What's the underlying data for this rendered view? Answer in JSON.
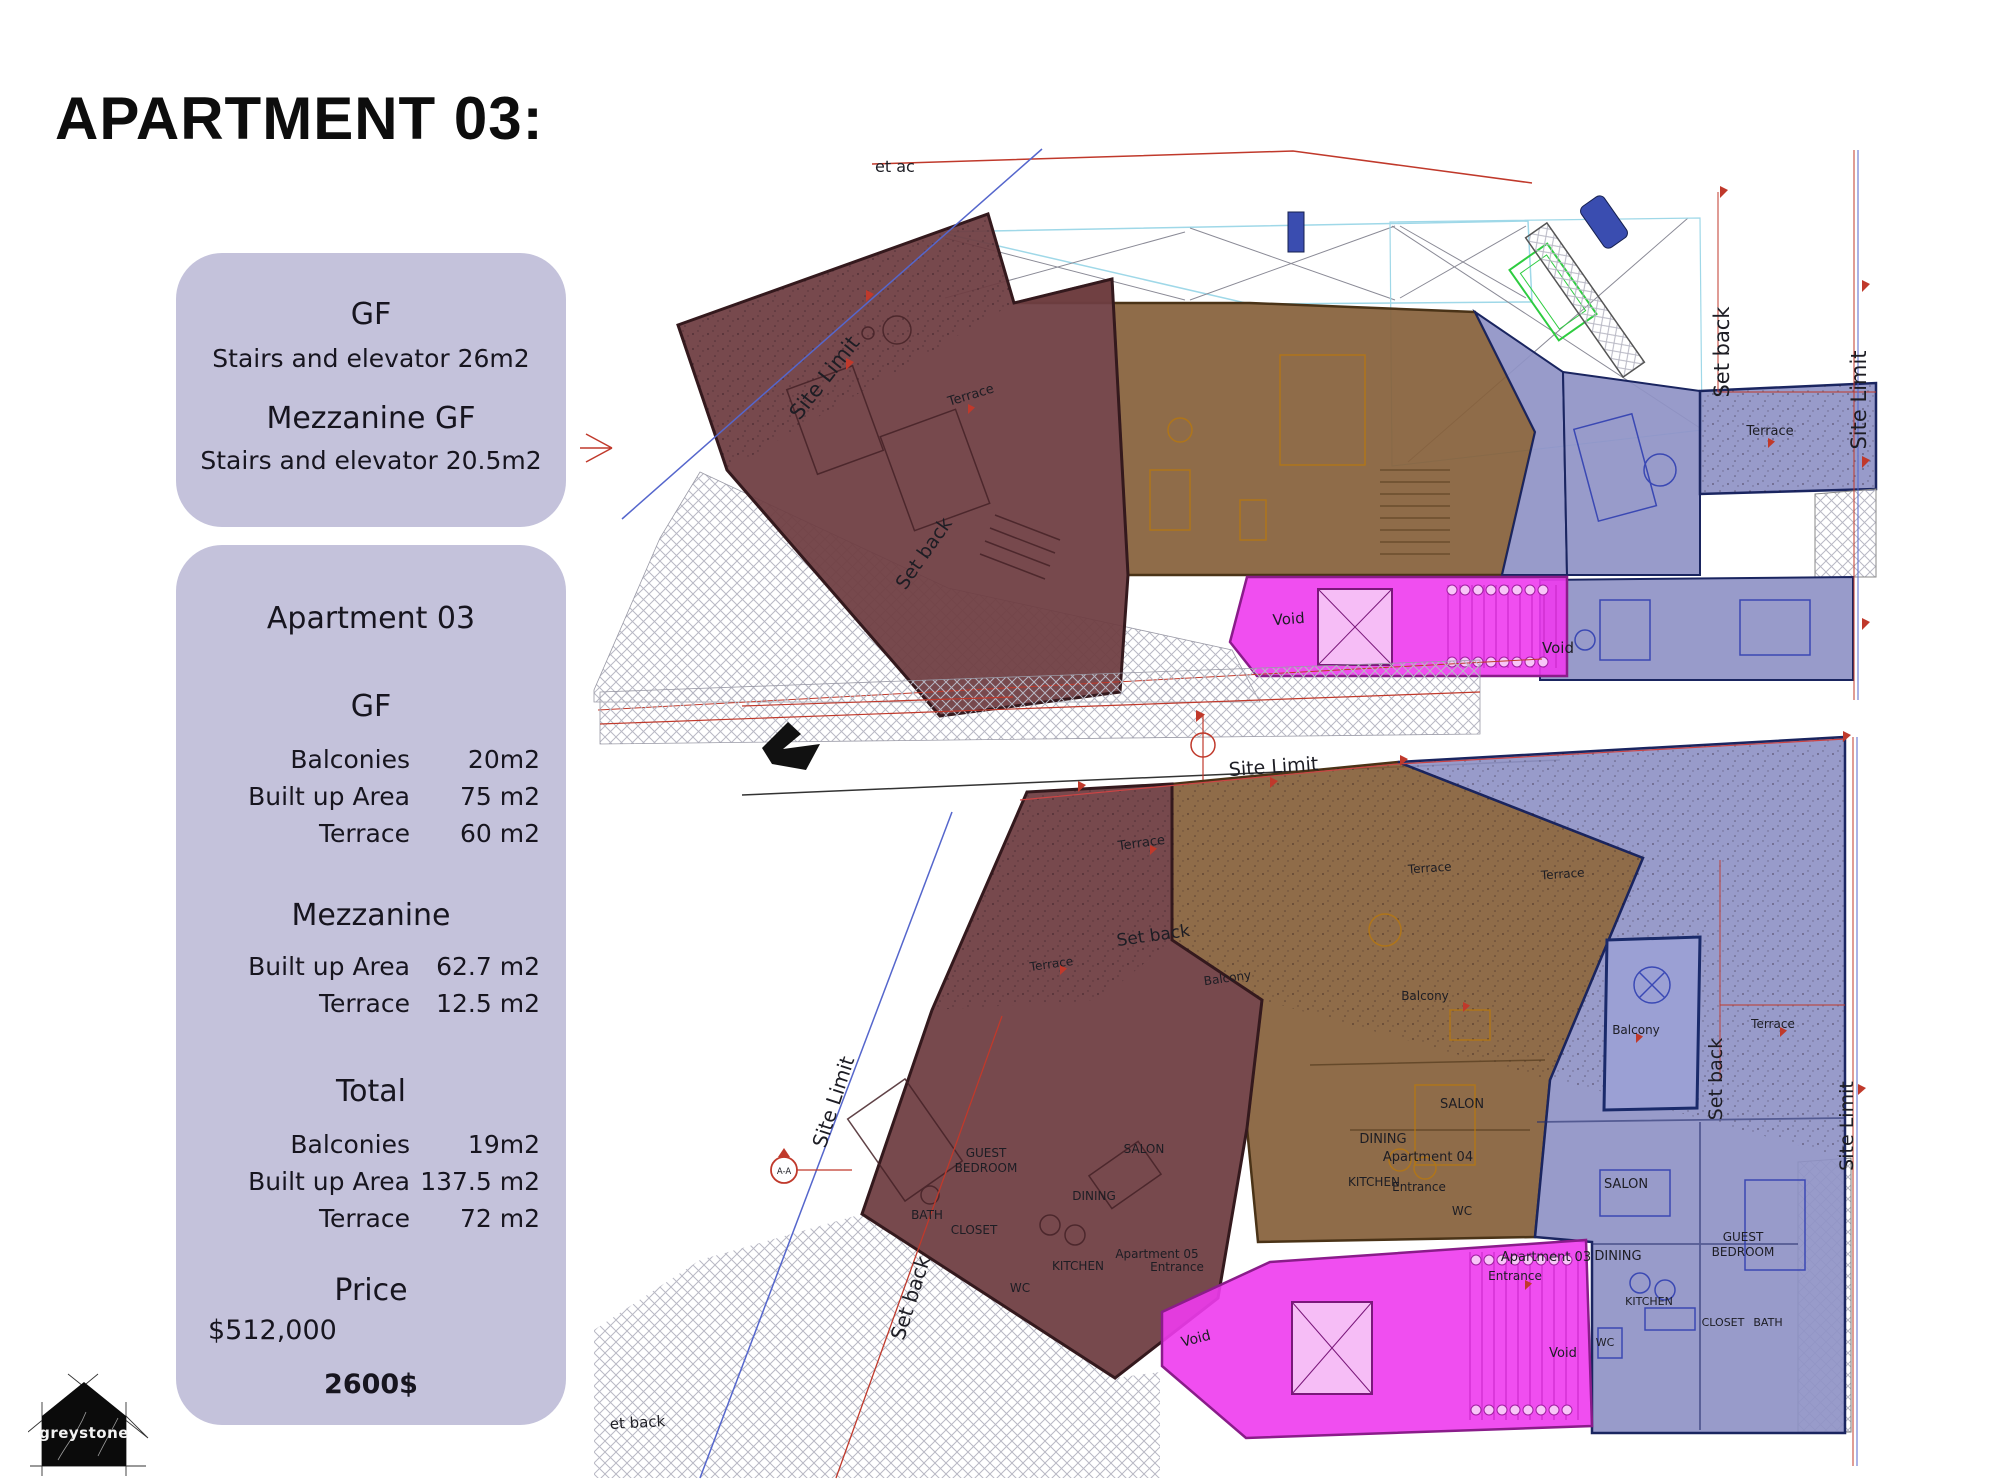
{
  "title": "APARTMENT 03:",
  "colors": {
    "card_background": "#c4c2db",
    "apartment03_overlay": "#8f93c6",
    "apartment04_overlay": "#85603a",
    "apartment05_overlay": "#6e3e42",
    "common_core_overlay": "#ee3bee",
    "site_limit_line": "#5566cc",
    "boundary_line_red": "#c0392b"
  },
  "summary_card": {
    "gf_title": "GF",
    "gf_line": "Stairs and elevator 26m2",
    "mezzanine_title": "Mezzanine GF",
    "mezzanine_line": "Stairs and elevator 20.5m2"
  },
  "details_card": {
    "title": "Apartment 03",
    "sections": [
      {
        "heading": "GF",
        "rows": [
          [
            "Balconies",
            "20m2"
          ],
          [
            "Built up Area",
            "75 m2"
          ],
          [
            "Terrace",
            "60 m2"
          ]
        ]
      },
      {
        "heading": "Mezzanine",
        "rows": [
          [
            "Built up Area",
            "62.7 m2"
          ],
          [
            "Terrace",
            "12.5 m2"
          ]
        ]
      },
      {
        "heading": "Total",
        "rows": [
          [
            "Balconies",
            "19m2"
          ],
          [
            "Built up Area",
            "137.5 m2"
          ],
          [
            "Terrace",
            "72 m2"
          ]
        ]
      }
    ],
    "price_heading": "Price",
    "price": "$512,000",
    "rate": "2600$"
  },
  "logo": {
    "text": "greystone"
  },
  "plans": {
    "top": {
      "name": "mezzanine-floor-plan",
      "labels": [
        {
          "id": "setback-top-partial",
          "text": "et  ac"
        },
        {
          "id": "site-limit-left",
          "text": "Site Limit"
        },
        {
          "id": "terrace-left",
          "text": "Terrace"
        },
        {
          "id": "setback-left",
          "text": "Set back"
        },
        {
          "id": "setback-right",
          "text": "Set back"
        },
        {
          "id": "site-limit-right",
          "text": "Site Limit"
        },
        {
          "id": "terrace-right",
          "text": "Terrace"
        },
        {
          "id": "void-left",
          "text": "Void"
        },
        {
          "id": "void-right",
          "text": "Void"
        }
      ]
    },
    "bottom": {
      "name": "ground-floor-plan",
      "labels": [
        {
          "id": "site-limit-top",
          "text": "Site Limit"
        },
        {
          "id": "site-limit-left",
          "text": "Site Limit"
        },
        {
          "id": "setback-left",
          "text": "Set back"
        },
        {
          "id": "terrace-1",
          "text": "Terrace"
        },
        {
          "id": "terrace-2",
          "text": "Terrace"
        },
        {
          "id": "setback-mid",
          "text": "Set back"
        },
        {
          "id": "balcony-apt05",
          "text": "Balcony"
        },
        {
          "id": "terrace-3",
          "text": "Terrace"
        },
        {
          "id": "terrace-4",
          "text": "Terrace"
        },
        {
          "id": "balcony-apt04",
          "text": "Balcony"
        },
        {
          "id": "salon-apt04",
          "text": "SALON"
        },
        {
          "id": "dining-apt04",
          "text": "DINING"
        },
        {
          "id": "apartment04",
          "text": "Apartment 04"
        },
        {
          "id": "kitchen-apt04",
          "text": "KITCHEN"
        },
        {
          "id": "entrance-apt04",
          "text": "Entrance"
        },
        {
          "id": "wc-apt04",
          "text": "WC"
        },
        {
          "id": "terrace-apt03",
          "text": "Terrace"
        },
        {
          "id": "balcony-apt03",
          "text": "Balcony"
        },
        {
          "id": "setback-right",
          "text": "Set back"
        },
        {
          "id": "site-limit-right",
          "text": "Site Limit"
        },
        {
          "id": "salon-apt03",
          "text": "SALON"
        },
        {
          "id": "apartment03",
          "text": "Apartment 03"
        },
        {
          "id": "dining-apt03",
          "text": "DINING"
        },
        {
          "id": "entrance-apt03",
          "text": "Entrance"
        },
        {
          "id": "guest-apt03-line1",
          "text": "GUEST"
        },
        {
          "id": "guest-apt03-line2",
          "text": "BEDROOM"
        },
        {
          "id": "kitchen-apt03",
          "text": "KITCHEN"
        },
        {
          "id": "closet-apt03",
          "text": "CLOSET"
        },
        {
          "id": "bath-apt03",
          "text": "BATH"
        },
        {
          "id": "wc-apt03",
          "text": "WC"
        },
        {
          "id": "guest-apt05-line1",
          "text": "GUEST"
        },
        {
          "id": "guest-apt05-line2",
          "text": "BEDROOM"
        },
        {
          "id": "bath-apt05",
          "text": "BATH"
        },
        {
          "id": "closet-apt05",
          "text": "CLOSET"
        },
        {
          "id": "salon-apt05",
          "text": "SALON"
        },
        {
          "id": "dining-apt05",
          "text": "DINING"
        },
        {
          "id": "kitchen-apt05",
          "text": "KITCHEN"
        },
        {
          "id": "wc-apt05",
          "text": "WC"
        },
        {
          "id": "apartment05",
          "text": "Apartment 05"
        },
        {
          "id": "entrance-apt05",
          "text": "Entrance"
        },
        {
          "id": "void-left",
          "text": "Void"
        },
        {
          "id": "void-right",
          "text": "Void"
        },
        {
          "id": "setback-bottom-partial",
          "text": "et back"
        },
        {
          "id": "section-marker",
          "text": "A-A"
        }
      ]
    }
  }
}
